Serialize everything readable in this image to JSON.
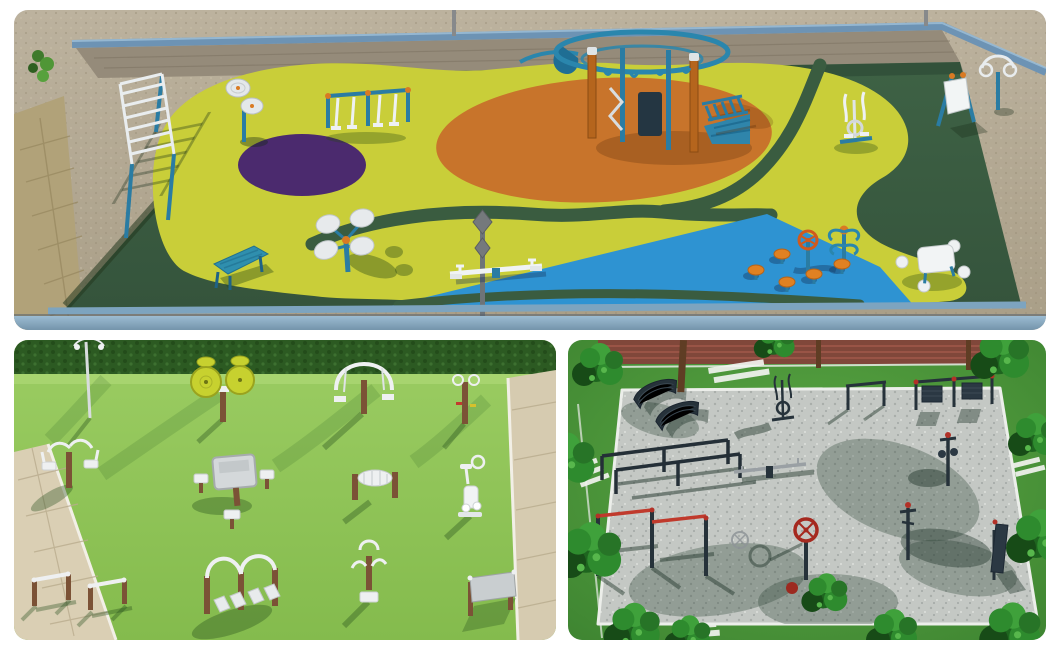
{
  "page": {
    "background": "#ffffff",
    "description": "Collage of three aerial 3D renders of outdoor fitness park designs"
  },
  "palette": {
    "surface_dark_green": "#3a5c40",
    "surface_yellow": "#c9ce39",
    "surface_orange": "#c8742b",
    "surface_purple": "#4b2a6e",
    "surface_blue": "#2e93d2",
    "curb_rail_blue": "#7da4bf",
    "sand": "#b5aa95",
    "equipment_teal": "#2a7ca3",
    "equipment_white": "#eef1f3",
    "accent_orange": "#d97a23",
    "grass_bright": "#8cc258",
    "hedge_green": "#2c5a22",
    "pavement_beige": "#dacfb4",
    "wood_brown": "#7b5236",
    "gravel_grey": "#c4c8c4",
    "steel_dark": "#26323a",
    "accent_red": "#b33127",
    "tree_green": "#2e8b2e"
  },
  "panels": [
    {
      "id": "top",
      "title": "Colorful rubber-surface fitness playground - aerial 3D render",
      "equipment": [
        "monkey-bar-ladder",
        "tai-chi-disc-spinner",
        "air-walker-pair",
        "climbing-dome-structure",
        "incline-ladder",
        "elliptical-trainer",
        "sign-board",
        "hanging-rings-station",
        "sit-up-bench",
        "four-disc-spinner",
        "street-lamp",
        "seesaw",
        "twister-station",
        "mushroom-stools",
        "steering-wheel",
        "picnic-table-set"
      ]
    },
    {
      "id": "bottom-left",
      "title": "Lawn outdoor gym with white equipment - aerial 3D render",
      "equipment": [
        "lamp-post",
        "twin-disc-spinner",
        "lat-pulldown",
        "handle-station",
        "chest-press",
        "picnic-table-set",
        "roller-station",
        "exercise-bike",
        "push-up-bars",
        "double-leg-press",
        "rider-machine",
        "sign-board"
      ]
    },
    {
      "id": "bottom-right",
      "title": "Gravel street-workout park among trees - aerial 3D render",
      "equipment": [
        "park-benches",
        "elliptical-trainer",
        "rack",
        "double-frame-station",
        "parallel-bars",
        "seesaw",
        "t-post-station",
        "red-pull-up-bars",
        "steering-wheel-spinner",
        "spinner-ball",
        "post-station",
        "info-board"
      ]
    }
  ]
}
